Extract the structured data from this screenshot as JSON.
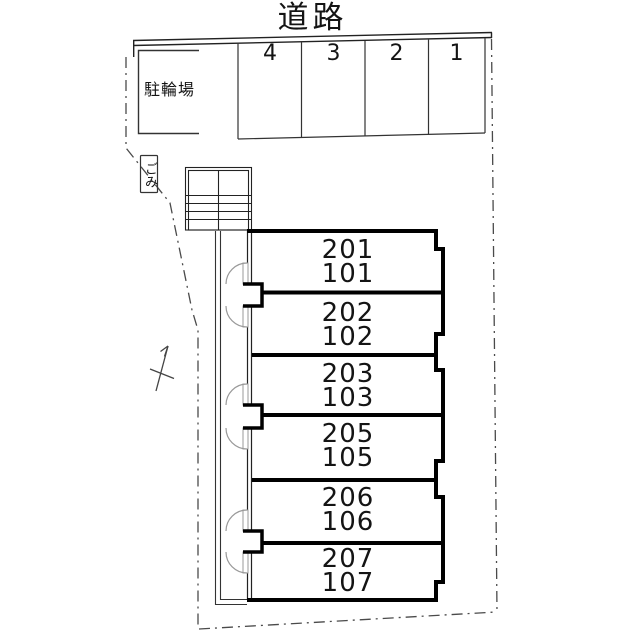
{
  "road": {
    "label": "道路"
  },
  "facilities": {
    "bicycle_parking": "駐輪場",
    "garbage": "ごみ"
  },
  "parking": {
    "stalls": [
      "4",
      "3",
      "2",
      "1"
    ]
  },
  "building": {
    "units": [
      {
        "upper": "201",
        "lower": "101"
      },
      {
        "upper": "202",
        "lower": "102"
      },
      {
        "upper": "203",
        "lower": "103"
      },
      {
        "upper": "205",
        "lower": "105"
      },
      {
        "upper": "206",
        "lower": "106"
      },
      {
        "upper": "207",
        "lower": "107"
      }
    ]
  },
  "palette": {
    "ink": "#1c1c1c",
    "wall": "#000000",
    "boundary_dash": "#4a4a4a",
    "door_arc": "#999999",
    "background": "#ffffff"
  }
}
